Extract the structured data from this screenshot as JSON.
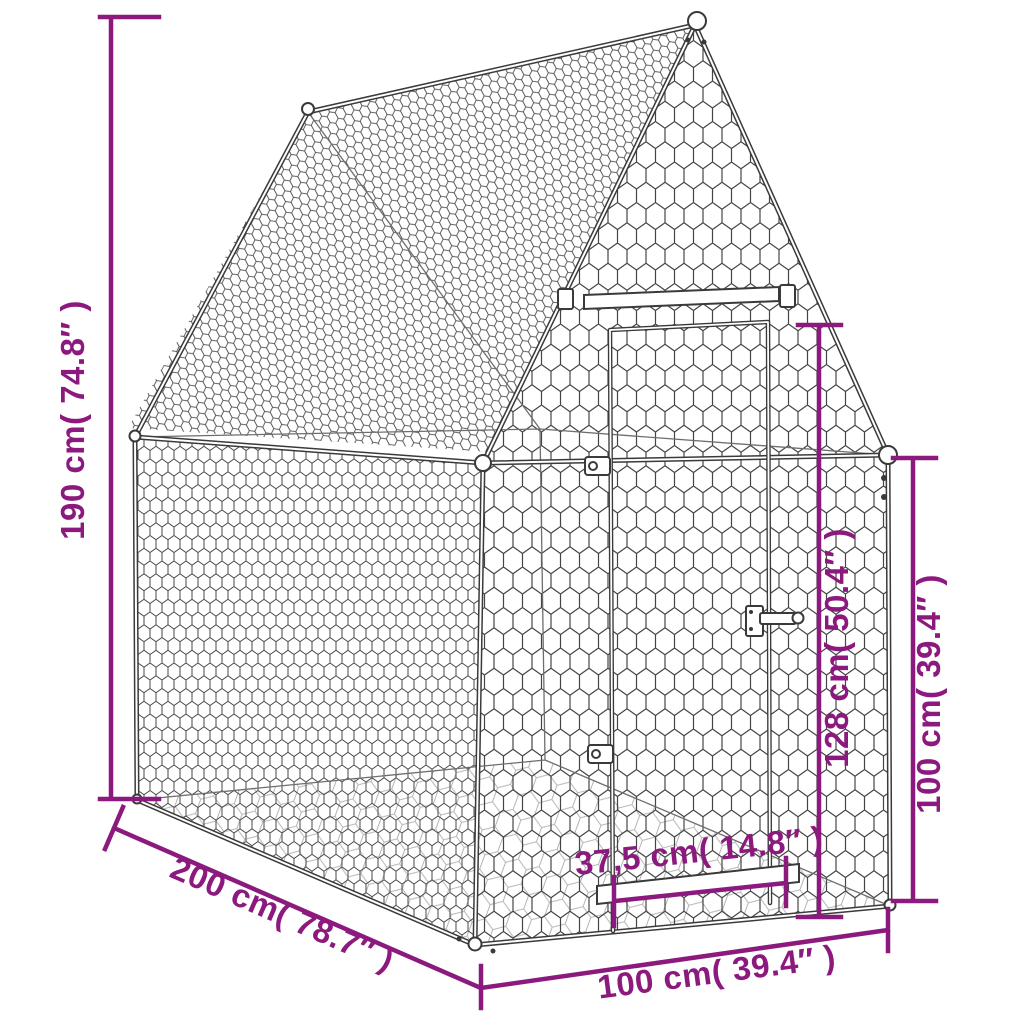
{
  "image": {
    "kind": "product-dimension-diagram",
    "subject": "wire-mesh chicken run with gable roof and front door",
    "background_color": "#ffffff"
  },
  "colors": {
    "dimension_annotation": "#8C1A7E",
    "frame_outline": "#3a3a3a",
    "mesh_wire": "#4a4a4a",
    "tube_highlight": "#ffffff"
  },
  "dimensions": {
    "total_height": "190 cm( 74.8″ )",
    "depth": "200 cm( 78.7″ )",
    "front_width": "100 cm( 39.4″ )",
    "door_height": "128 cm( 50.4″ )",
    "wall_height": "100 cm( 39.4″ )",
    "door_width": "37,5 cm( 14.8″ )"
  }
}
